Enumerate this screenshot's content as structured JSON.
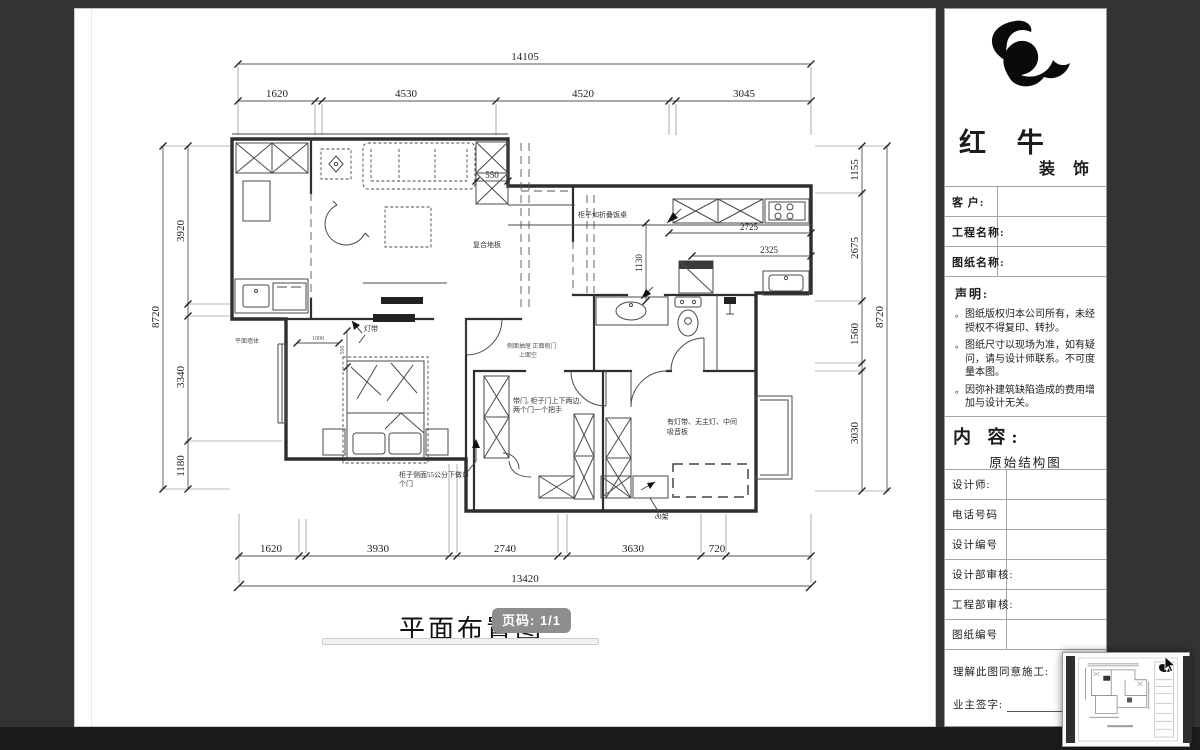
{
  "colors": {
    "canvas_bg": "#333333",
    "page_bg": "#ffffff",
    "badge_bg": "#8d8d8d",
    "line": "#3c3c3c"
  },
  "page": {
    "plan_title": "平面布置图",
    "scale_fragment": "1",
    "page_badge": "页码: 1/1"
  },
  "plan": {
    "dims": {
      "top_overall": "14105",
      "top_segments": [
        "1620",
        "4530",
        "4520",
        "3045"
      ],
      "bottom_overall": "13420",
      "bottom_segments": [
        "1620",
        "3930",
        "2740",
        "3630",
        "720"
      ],
      "left_overall": "8720",
      "left_segments": [
        "3920",
        "3340",
        "1180"
      ],
      "right_overall": "8720",
      "right_segments": [
        "1155",
        "2675",
        "1560",
        "3030"
      ],
      "closet_depth": "550",
      "kitchen_a": "2725",
      "kitchen_b": "2325",
      "kitchen_c": "1130",
      "bed_a": "1000",
      "bed_b": "500"
    },
    "labels": {
      "floor_material": "复合地板",
      "folding_table": "柜子如折叠饭桌",
      "light_strip": "灯带",
      "drawer_note1": "侧面抽屉  正面假门",
      "drawer_note2": "上面空",
      "wardrobe_note1": "带门, 柜子门上下两边,",
      "wardrobe_note2": "两个门一个把手",
      "cabinet_note1": "柜子侧面55公分下做单",
      "cabinet_note2": "个门",
      "bedroom_note1": "有灯带、无主灯、中间",
      "bedroom_note2": "吸音板",
      "cd_rack": "cd架",
      "wall_note": "平面墙体"
    }
  },
  "titleblock": {
    "brand_main": "红 牛",
    "brand_sub": "装 饰",
    "bullet": "。",
    "row_labels": {
      "client": "客  户:",
      "project": "工程名称:",
      "drawing": "图纸名称:"
    },
    "statement_title": "声明:",
    "statement_items": [
      "图纸版权归本公司所有，未经授权不得复印、转抄。",
      "图纸尺寸以现场为准，如有疑问，请与设计师联系。不可度量本图。",
      "因弥补建筑缺陷造成的费用增加与设计无关。"
    ],
    "content_label": "内 容:",
    "content_value": "原始结构图",
    "field_labels": [
      "设计师:",
      "电话号码",
      "设计编号",
      "设计部审核:",
      "工程部审核:",
      "图纸编号"
    ],
    "footer_line1": "理解此图同意施工:",
    "footer_line2": "业主签字:"
  }
}
